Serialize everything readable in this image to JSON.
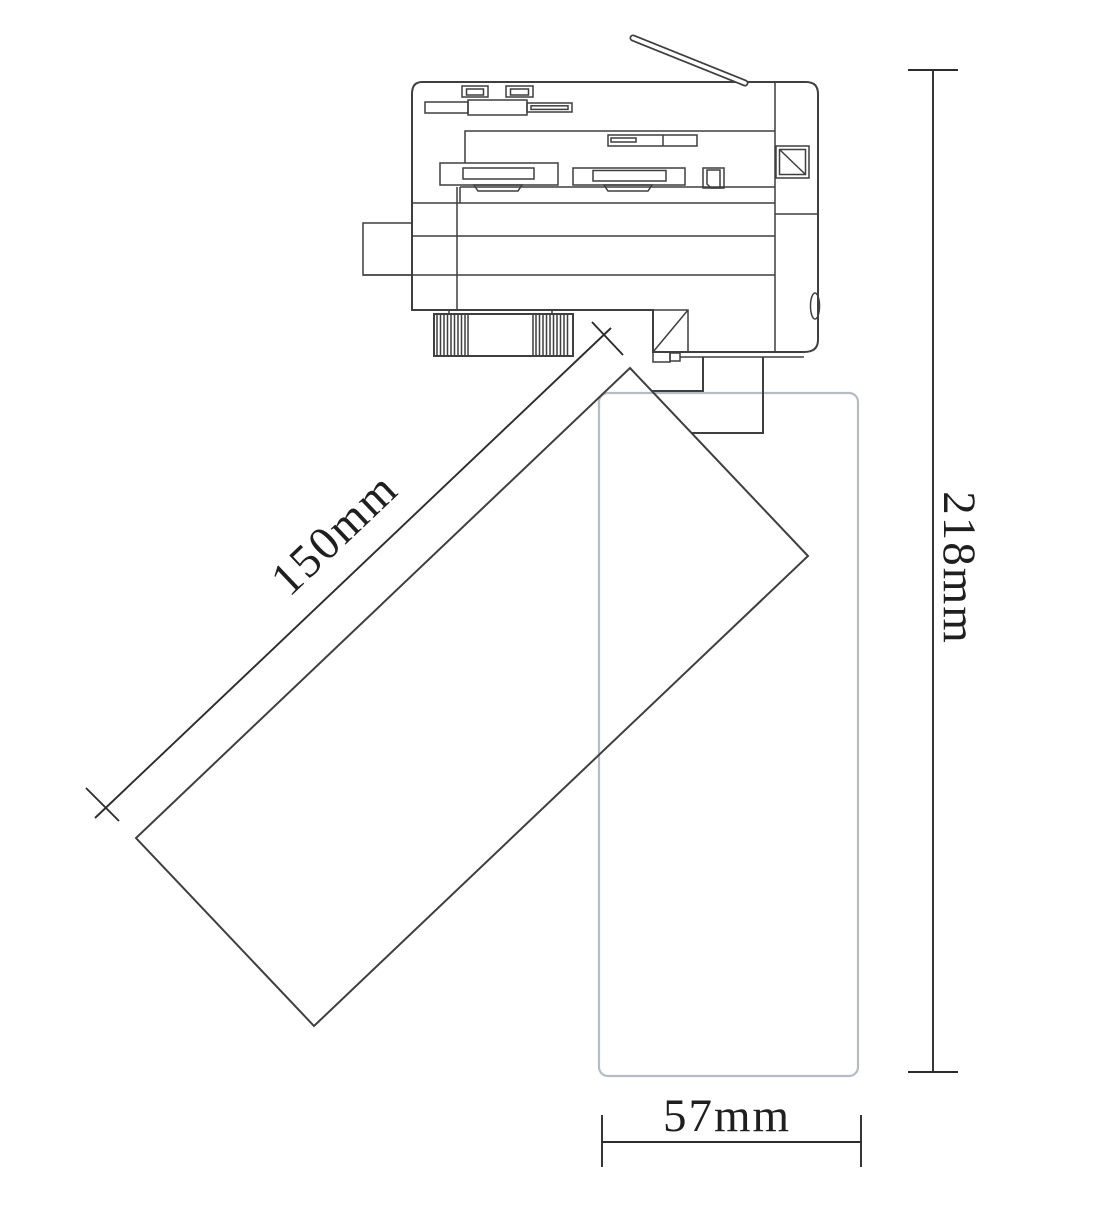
{
  "drawing": {
    "unit": "mm",
    "labels": {
      "body_length": "150mm",
      "overall_height": "218mm",
      "body_width": "57mm"
    },
    "values": {
      "body_length": 150,
      "overall_height": 218,
      "body_width": 57
    }
  },
  "colors": {
    "line": "#3f3f3f",
    "dim": "#2c2c2c",
    "ghost": "#b6bcc3",
    "text": "#1f1f1f",
    "background": "#ffffff"
  }
}
